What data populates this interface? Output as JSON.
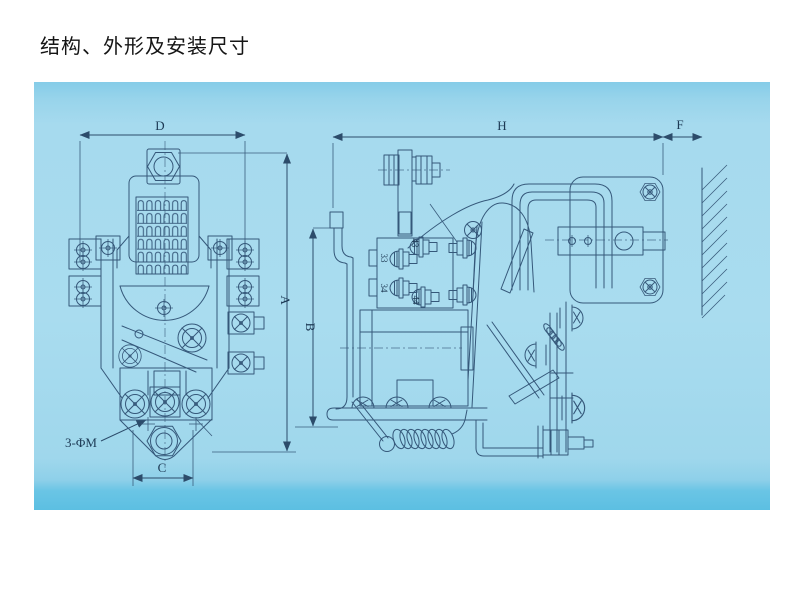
{
  "title": "结构、外形及安装尺寸",
  "colors": {
    "panel_top": "#85cce8",
    "panel_main": "#a9dcef",
    "panel_bottom": "#5cbfe2",
    "line": "#35587a",
    "dim_text": "#1d3a55",
    "title_text": "#151515"
  },
  "front_view": {
    "dim_top": "D",
    "dim_right": "A",
    "dim_bottom": "C",
    "mounting_note": "3-ΦM"
  },
  "side_view": {
    "dim_top": "H",
    "dim_wall_gap": "F",
    "dim_left": "B",
    "terminal_labels": [
      "43",
      "33",
      "34",
      "44"
    ]
  }
}
